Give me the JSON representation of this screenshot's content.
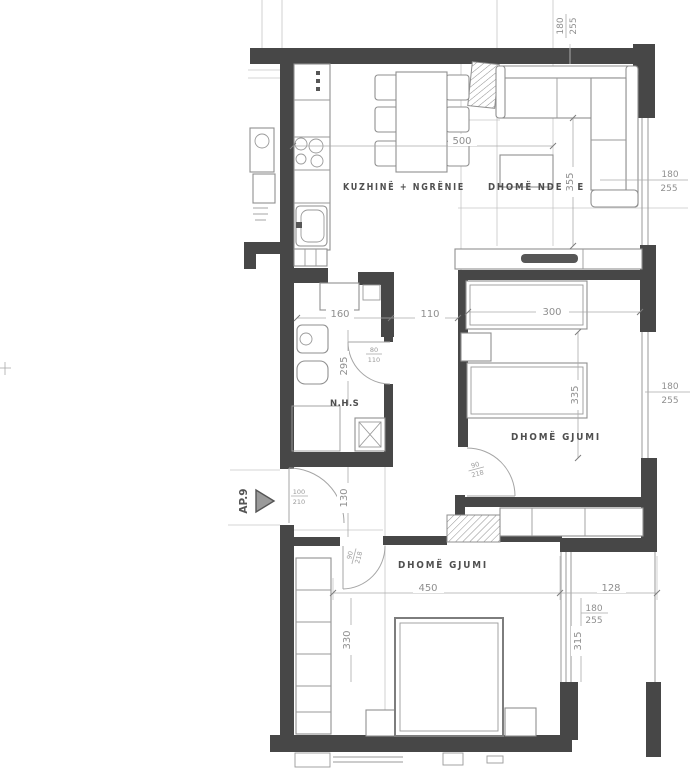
{
  "plan": {
    "entrance": {
      "label": "AP.9"
    },
    "rooms": {
      "kitchen_dining": "KUZHINË + NGRËNIE",
      "living": "DHOMË NDENJE",
      "bedroom1": "DHOMË GJUMI",
      "bedroom2": "DHOMË GJUMI",
      "bath": "N.H.S"
    },
    "dims": {
      "dining_width": "500",
      "living_depth": "355",
      "bed1_width": "300",
      "bed1_depth": "335",
      "bath_width": "160",
      "hall_width": "110",
      "bath_depth": "295",
      "hall_depth": "130",
      "bed2_width": "450",
      "bed2_depth": "330",
      "balcony_width": "128",
      "balcony_depth": "315"
    },
    "windows": {
      "top": {
        "w": "180",
        "h": "255"
      },
      "living": {
        "w": "180",
        "h": "255"
      },
      "bedroom1": {
        "w": "180",
        "h": "255"
      },
      "balcony": {
        "w": "180",
        "h": "255"
      }
    },
    "doors": {
      "entry": {
        "w": "100",
        "h": "210"
      },
      "bath": {
        "w": "80",
        "h": "110"
      },
      "bedroom1": {
        "w": "90",
        "h": "218"
      },
      "bedroom2": {
        "w": "90",
        "h": "218"
      }
    },
    "colors": {
      "wall": "#474747",
      "furniture_line": "#8f8f8f",
      "dim_text": "#8f8f8f",
      "label_text": "#4f4f4f",
      "paper": "#ffffff"
    }
  }
}
